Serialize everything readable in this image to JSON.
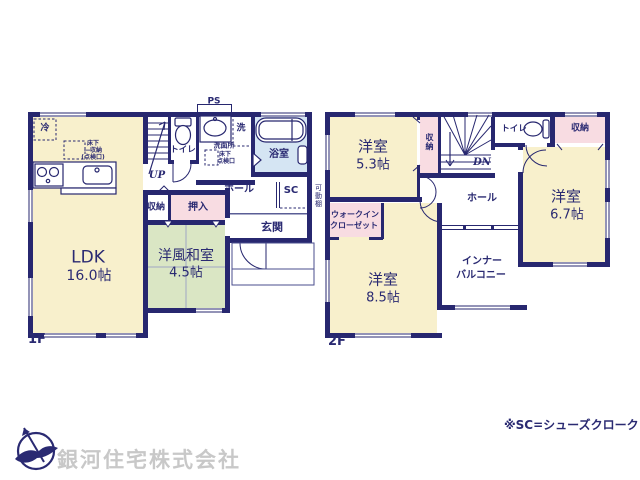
{
  "footer": {
    "company": "銀河住宅株式会社",
    "note": "※SC=シューズクローク"
  },
  "annotations": {
    "ps": "PS",
    "movable_shelf": "可動棚"
  },
  "floor1": {
    "label": "1F",
    "ldk": {
      "name": "LDK",
      "size": "16.0帖"
    },
    "washitsu": {
      "name": "洋風和室",
      "size": "4.5帖"
    },
    "fridge": "冷",
    "floor_storage": {
      "l1": "床下",
      "l2": "―収納",
      "l3": "(点検口)"
    },
    "stairs_dir": "UP",
    "toilet": "トイレ",
    "washroom": "洗面所",
    "floor_hatch": {
      "l1": "床下",
      "l2": "点検口"
    },
    "laundry": "洗",
    "bath": "浴室",
    "hall": "ホール",
    "shoe_closet": "SC",
    "closet": "収納",
    "oshiire": "押入",
    "entrance": "玄関"
  },
  "floor2": {
    "label": "2F",
    "stairs_dir": "DN",
    "bedroom_a": {
      "name": "洋室",
      "size": "5.3帖"
    },
    "bedroom_b": {
      "name": "洋室",
      "size": "6.7帖"
    },
    "bedroom_c": {
      "name": "洋室",
      "size": "8.5帖"
    },
    "closet_a": "収納",
    "closet_b": "収納",
    "toilet": "トイレ",
    "hall": "ホール",
    "wic": {
      "l1": "ウォークイン",
      "l2": "クローゼット"
    },
    "inner_balcony": {
      "l1": "インナー",
      "l2": "バルコニー"
    }
  }
}
